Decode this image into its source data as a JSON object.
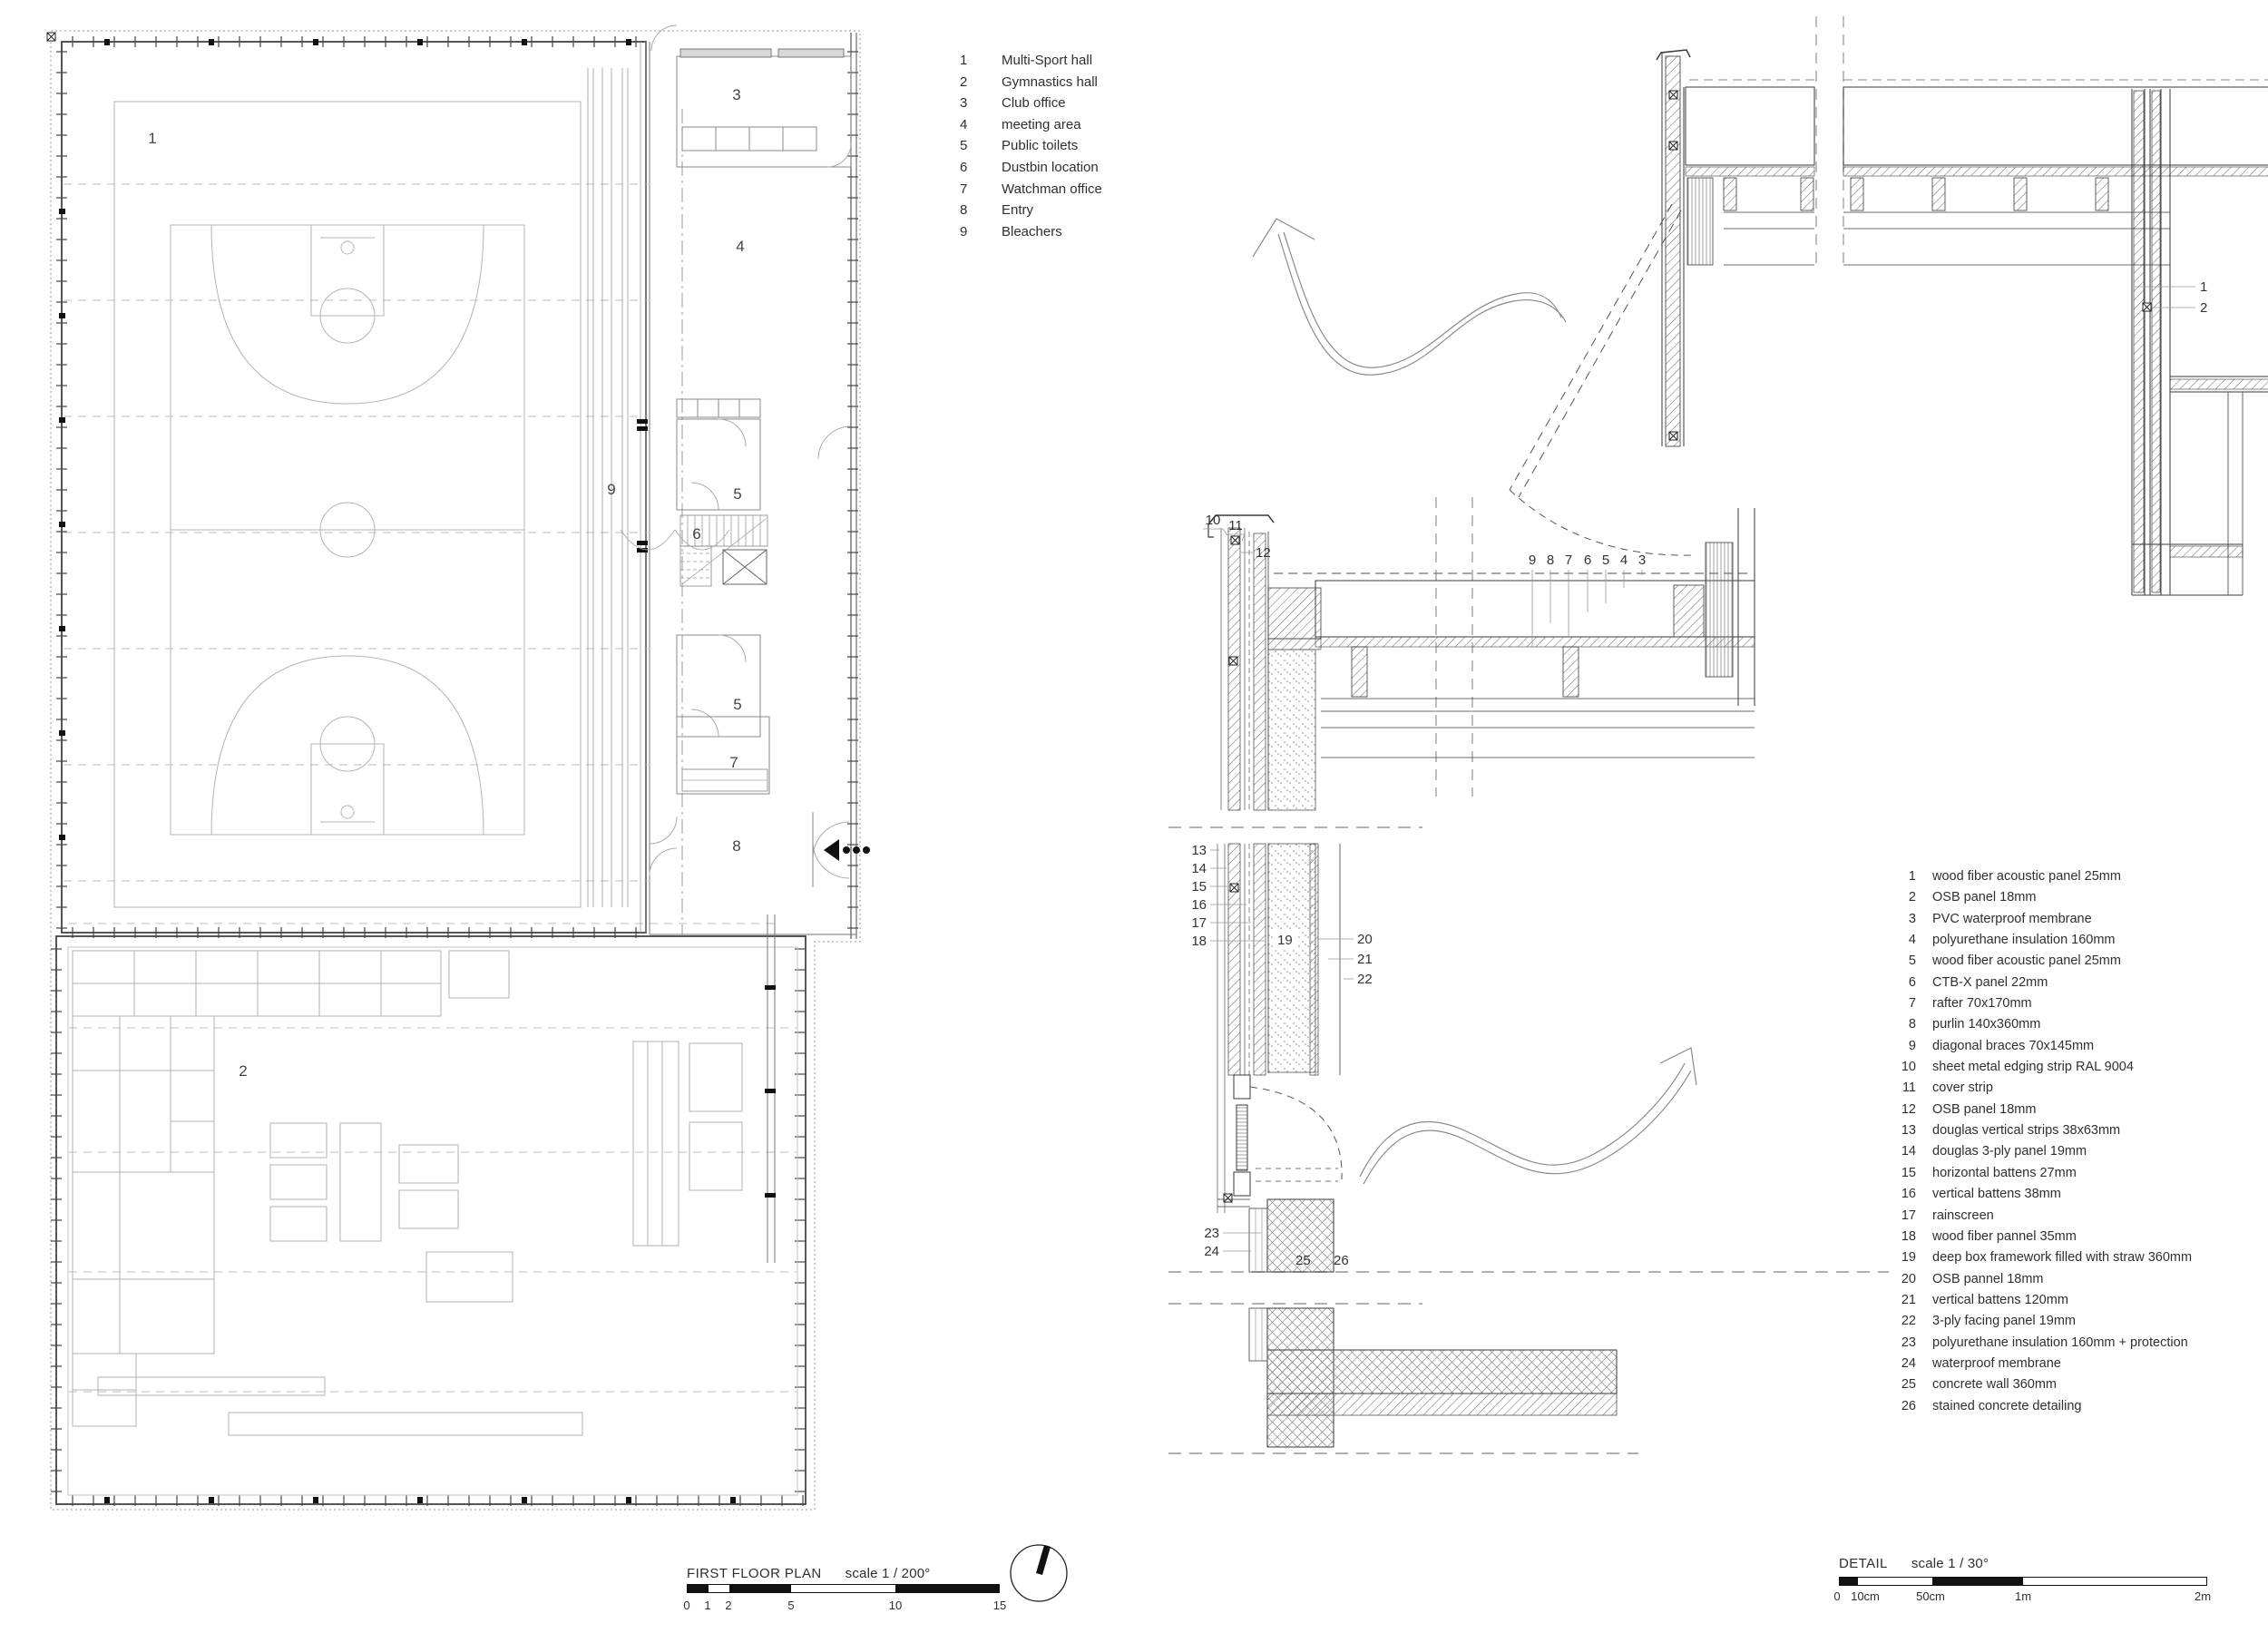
{
  "sheet": {
    "plan": {
      "title": "FIRST FLOOR PLAN",
      "scale": "scale 1 / 200°",
      "scale_ticks": [
        "0",
        "1",
        "2",
        "5",
        "10",
        "15"
      ],
      "legend": [
        {
          "num": "1",
          "label": "Multi-Sport hall"
        },
        {
          "num": "2",
          "label": "Gymnastics hall"
        },
        {
          "num": "3",
          "label": "Club office"
        },
        {
          "num": "4",
          "label": "meeting area"
        },
        {
          "num": "5",
          "label": "Public toilets"
        },
        {
          "num": "6",
          "label": "Dustbin location"
        },
        {
          "num": "7",
          "label": "Watchman office"
        },
        {
          "num": "8",
          "label": "Entry"
        },
        {
          "num": "9",
          "label": "Bleachers"
        }
      ],
      "rooms": {
        "multisport": "1",
        "gym": "2",
        "office": "3",
        "meeting": "4",
        "toilets_a": "5",
        "dustbin": "6",
        "toilets_b": "5",
        "watchman": "7",
        "entry": "8",
        "bleachers": "9"
      }
    },
    "detail": {
      "title": "DETAIL",
      "scale": "scale 1 / 30°",
      "scale_ticks": [
        "0",
        "10cm",
        "50cm",
        "1m",
        "2m"
      ],
      "legend": [
        {
          "num": "1",
          "label": "wood fiber acoustic panel 25mm"
        },
        {
          "num": "2",
          "label": "OSB panel 18mm"
        },
        {
          "num": "3",
          "label": "PVC waterproof membrane"
        },
        {
          "num": "4",
          "label": "polyurethane insulation 160mm"
        },
        {
          "num": "5",
          "label": "wood fiber acoustic panel 25mm"
        },
        {
          "num": "6",
          "label": "CTB-X panel 22mm"
        },
        {
          "num": "7",
          "label": "rafter 70x170mm"
        },
        {
          "num": "8",
          "label": "purlin 140x360mm"
        },
        {
          "num": "9",
          "label": "diagonal braces 70x145mm"
        },
        {
          "num": "10",
          "label": "sheet metal edging strip RAL 9004"
        },
        {
          "num": "11",
          "label": "cover strip"
        },
        {
          "num": "12",
          "label": "OSB panel 18mm"
        },
        {
          "num": "13",
          "label": "douglas vertical strips 38x63mm"
        },
        {
          "num": "14",
          "label": "douglas 3-ply panel 19mm"
        },
        {
          "num": "15",
          "label": "horizontal battens 27mm"
        },
        {
          "num": "16",
          "label": "vertical battens 38mm"
        },
        {
          "num": "17",
          "label": "rainscreen"
        },
        {
          "num": "18",
          "label": "wood fiber pannel 35mm"
        },
        {
          "num": "19",
          "label": "deep box framework filled with straw 360mm"
        },
        {
          "num": "20",
          "label": "OSB pannel 18mm"
        },
        {
          "num": "21",
          "label": "vertical battens 120mm"
        },
        {
          "num": "22",
          "label": "3-ply facing panel 19mm"
        },
        {
          "num": "23",
          "label": "polyurethane insulation 160mm + protection"
        },
        {
          "num": "24",
          "label": "waterproof membrane"
        },
        {
          "num": "25",
          "label": "concrete wall 360mm"
        },
        {
          "num": "26",
          "label": "stained concrete detailing"
        }
      ],
      "callouts": {
        "roof": [
          "9",
          "8",
          "7",
          "6",
          "5",
          "4",
          "3"
        ],
        "right_wall": [
          "1",
          "2"
        ],
        "parapet": [
          "10",
          "11",
          "12"
        ],
        "left_wall": [
          "13",
          "14",
          "15",
          "16",
          "17",
          "18"
        ],
        "core": "19",
        "inner_face": [
          "20",
          "21",
          "22"
        ],
        "base": [
          "23",
          "24"
        ],
        "foundation": [
          "25",
          "26"
        ]
      }
    }
  }
}
